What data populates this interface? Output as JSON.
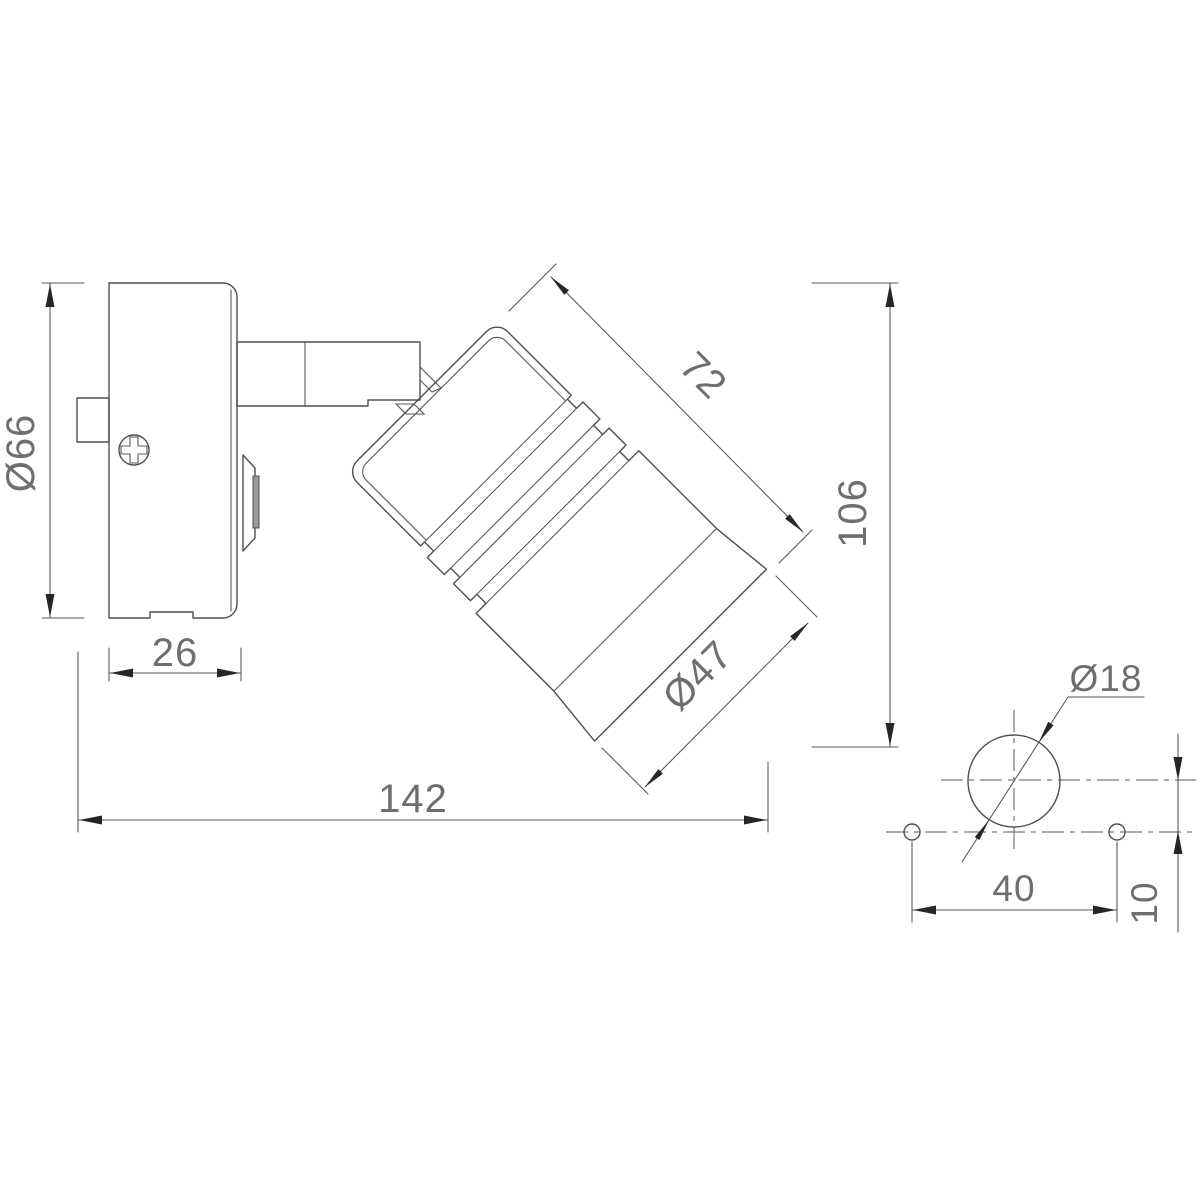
{
  "drawing": {
    "type": "technical-dimension-drawing",
    "views": {
      "main": "side view of wall-mounted spotlight",
      "detail": "mounting plate hole pattern"
    },
    "colors": {
      "background": "#ffffff",
      "line": "#4f4f4f",
      "dimension_line": "#5a5a5a",
      "arrow": "#262626",
      "text": "#6e6e6e",
      "knob_band": "#9a9a9a"
    },
    "dims": {
      "d66": "Ø66",
      "d26": "26",
      "d142": "142",
      "d72": "72",
      "d106": "106",
      "d47": "Ø47",
      "d18": "Ø18",
      "d40": "40",
      "d10": "10"
    }
  }
}
